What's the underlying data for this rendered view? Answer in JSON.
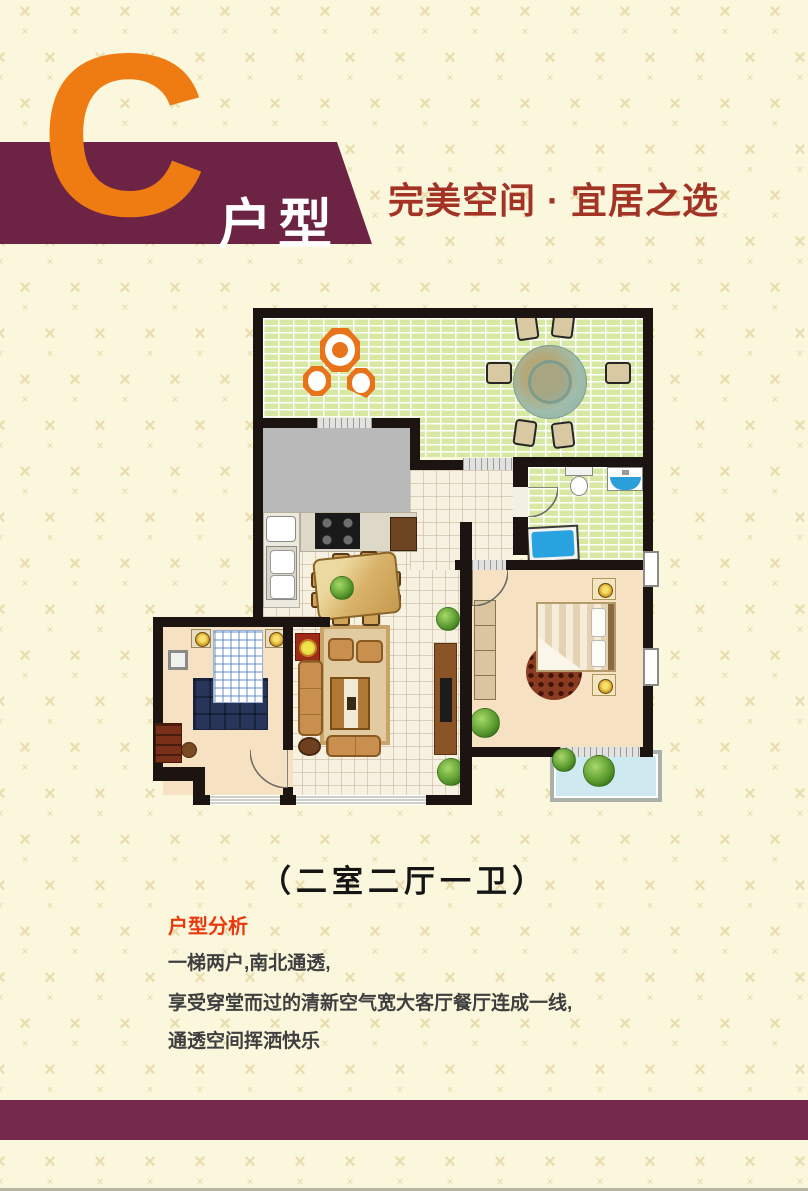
{
  "header": {
    "block_letter": "C",
    "unit_type_label": "户型",
    "slogan": "完美空间 · 宜居之选",
    "colors": {
      "banner": "#6d2343",
      "letter": "#ee7c12",
      "slogan": "#a23325"
    }
  },
  "floor_plan": {
    "caption": "（二室二厅一卫）"
  },
  "analysis": {
    "heading": "户型分析",
    "heading_color": "#e8390e",
    "lines": [
      "一梯两户,南北通透,",
      "享受穿堂而过的清新空气宽大客厅餐厅连成一线,",
      "通透空间挥洒快乐"
    ]
  },
  "footer": {
    "band_color": "#75294c"
  },
  "background": {
    "base_color": "#fbf7dc",
    "motif_icon": "x-motif",
    "motif_color": "#e9dcae"
  }
}
